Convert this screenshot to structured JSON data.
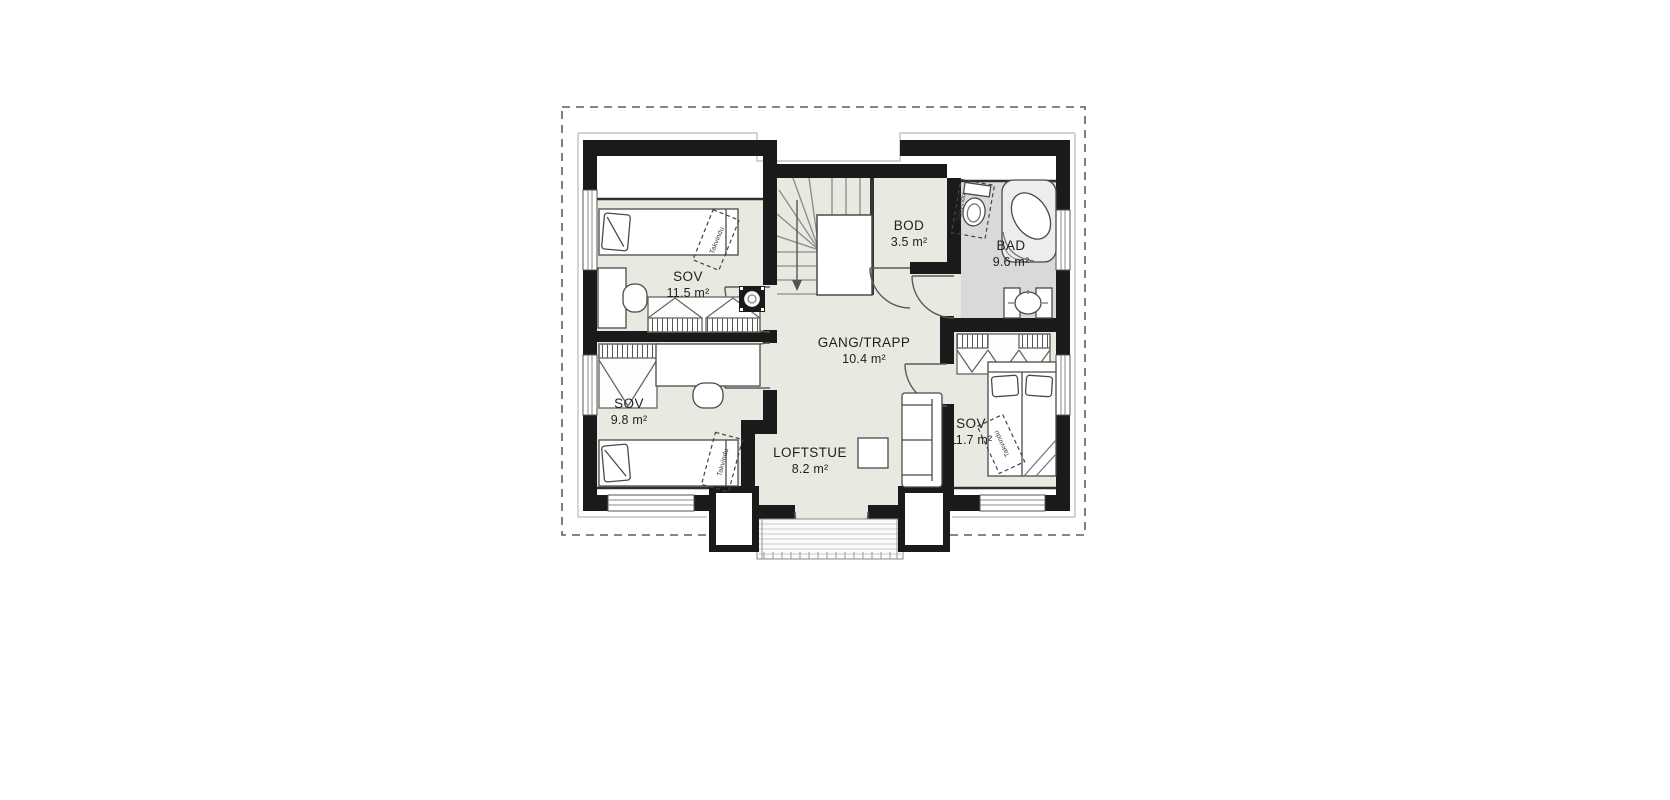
{
  "floorplan": {
    "title": "second-floor-plan",
    "rooms": [
      {
        "name": "SOV",
        "area": "11.5 m²"
      },
      {
        "name": "SOV",
        "area": "9.8 m²"
      },
      {
        "name": "BOD",
        "area": "3.5 m²"
      },
      {
        "name": "BAD",
        "area": "9.6 m²"
      },
      {
        "name": "GANG/TRAPP",
        "area": "10.4 m²"
      },
      {
        "name": "LOFTSTUE",
        "area": "8.2 m²"
      },
      {
        "name": "SOV",
        "area": "11.7 m²"
      }
    ],
    "skylight_label": "Takvindu",
    "colors": {
      "wall": "#1a1a1a",
      "room_floor": "#e9e8e1",
      "bath_floor": "#d9d9db",
      "outline": "#4a4a4a",
      "roof_dash": "#5f5f5f"
    }
  }
}
